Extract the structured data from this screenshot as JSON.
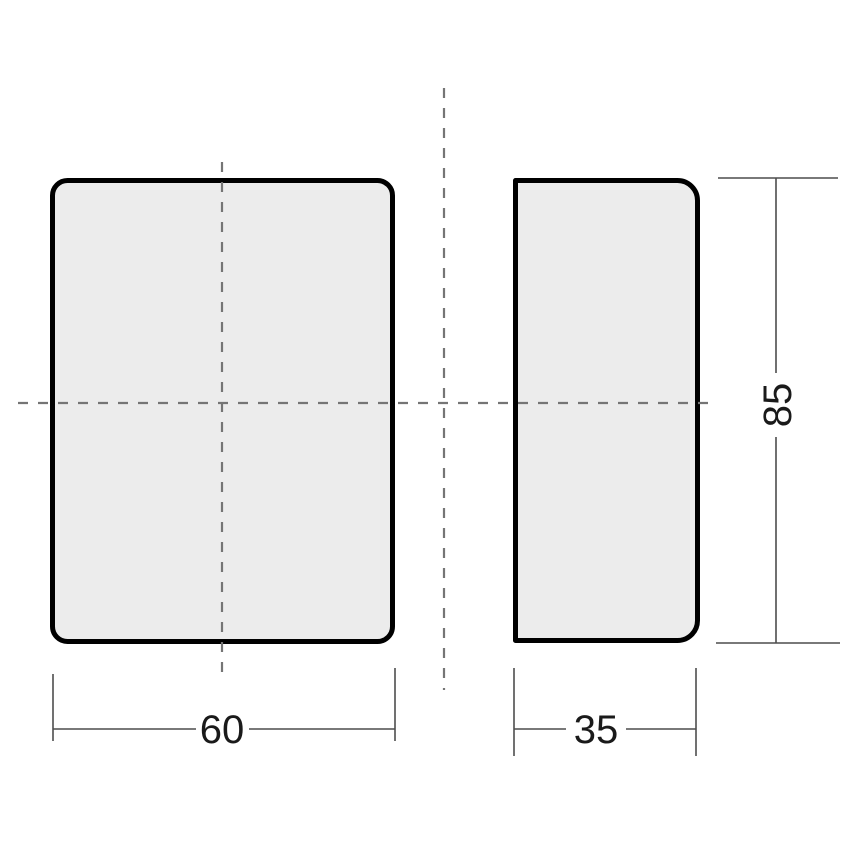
{
  "drawing": {
    "type": "orthographic-technical-drawing",
    "views": [
      "front-view",
      "side-view"
    ],
    "dimensions": {
      "front_width": "60",
      "side_depth": "35",
      "height": "85"
    }
  },
  "colors": {
    "background": "#ffffff",
    "part-fill": "#ececec",
    "part-outline": "#000000",
    "centerline": "#757575",
    "dim-line": "#4d4d4d",
    "dim-text": "#1a1a1a"
  }
}
